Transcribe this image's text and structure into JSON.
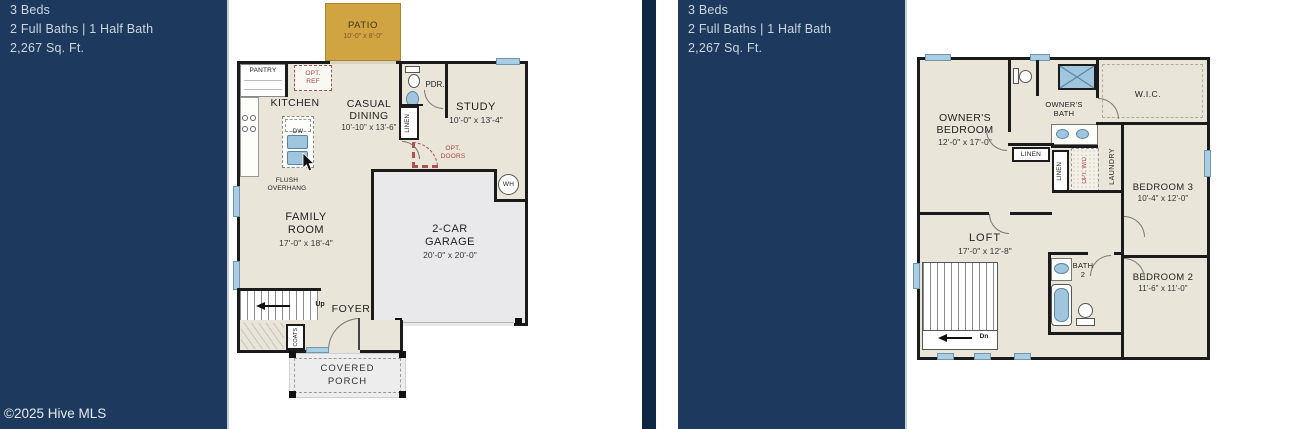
{
  "sidebar": {
    "beds": "3 Beds",
    "baths": "2 Full Baths | 1 Half Bath",
    "sqft": "2,267 Sq. Ft.",
    "copyright": "©2025 Hive MLS"
  },
  "floor1": {
    "patio": "PATIO",
    "patio_dims": "10'-0\" x 8'-0\"",
    "pantry": "PANTRY",
    "opt_ref_1": "OPT.",
    "opt_ref_2": "REF",
    "kitchen": "KITCHEN",
    "dw": "DW",
    "flush_1": "FLUSH",
    "flush_2": "OVERHANG",
    "casual_1": "CASUAL",
    "casual_2": "DINING",
    "casual_dims": "10'-10\" x 13'-6\"",
    "pdr": "PDR.",
    "linen": "LINEN",
    "study": "STUDY",
    "study_dims": "10'-0\" x 13'-4\"",
    "opt_doors_1": "OPT.",
    "opt_doors_2": "DOORS",
    "family_1": "FAMILY",
    "family_2": "ROOM",
    "family_dims": "17'-0\" x 18'-4\"",
    "garage_1": "2-CAR",
    "garage_2": "GARAGE",
    "garage_dims": "20'-0\" x 20'-0\"",
    "wh": "WH",
    "up": "Up",
    "foyer": "FOYER",
    "coats": "COATS",
    "porch_1": "COVERED",
    "porch_2": "PORCH"
  },
  "floor2": {
    "owners_1": "OWNER'S",
    "owners_2": "BEDROOM",
    "owners_dims": "12'-0\" x 17'-0\"",
    "obath_1": "OWNER'S",
    "obath_2": "BATH",
    "wic": "W.I.C.",
    "linen_a": "LINEN",
    "linen_b": "LINEN",
    "opt_wd": "OPT. W/D",
    "laundry": "LAUNDRY",
    "bed3": "BEDROOM 3",
    "bed3_dims": "10'-4\" x 12'-0\"",
    "loft": "LOFT",
    "loft_dims": "17'-0\" x 12'-8\"",
    "bath2_1": "BATH",
    "bath2_2": "2",
    "bed2": "BEDROOM 2",
    "bed2_dims": "11'-6\" x 11'-0\"",
    "dn": "Dn"
  },
  "colors": {
    "sidebar_navy": "#1d3a5e",
    "divider_navy": "#0e2744",
    "floor_beige": "#eae5d9",
    "garage_gray": "#e9e9ec",
    "patio_gold": "#d0a441",
    "window_blue": "#a9cde3",
    "wall_black": "#1b1b1b",
    "option_red": "#a94442"
  }
}
